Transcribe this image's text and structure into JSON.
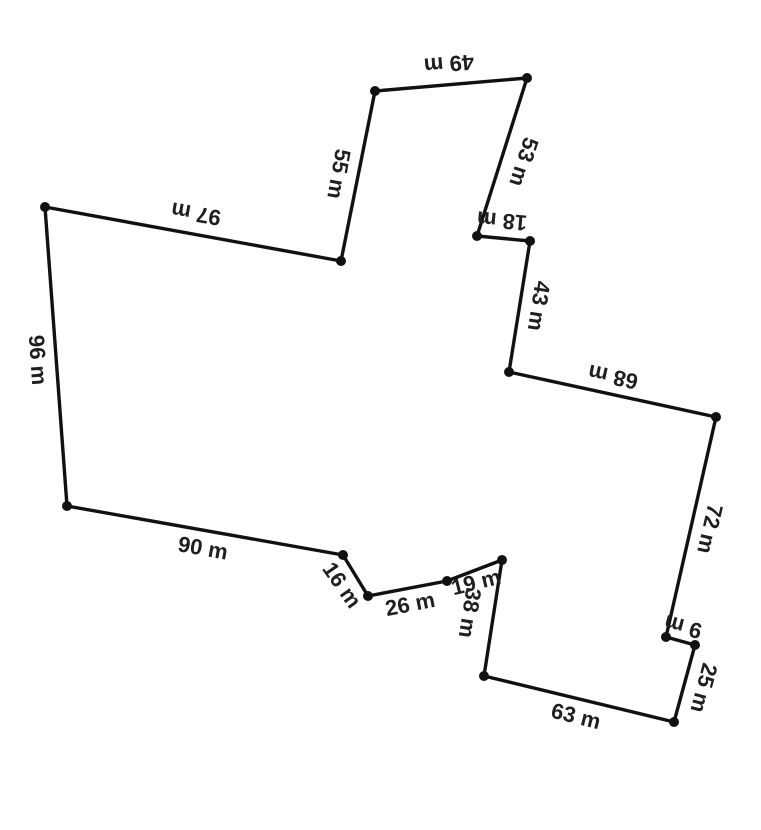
{
  "canvas": {
    "width": 761,
    "height": 830,
    "background": "#ffffff"
  },
  "style": {
    "line_color": "#111111",
    "line_width": 3.4,
    "vertex_color": "#111111",
    "vertex_radius": 5,
    "label_color": "#1f1f1f",
    "label_font_size": 22
  },
  "shape": {
    "type": "closed-polygon",
    "unit": "m",
    "vertices": [
      [
        45,
        207
      ],
      [
        341,
        261
      ],
      [
        375,
        91
      ],
      [
        527,
        78
      ],
      [
        477,
        236
      ],
      [
        530,
        241
      ],
      [
        509,
        372
      ],
      [
        716,
        417
      ],
      [
        666,
        637
      ],
      [
        695,
        645
      ],
      [
        674,
        722
      ],
      [
        484,
        676
      ],
      [
        502,
        560
      ],
      [
        447,
        581
      ],
      [
        368,
        596
      ],
      [
        343,
        555
      ],
      [
        67,
        506
      ]
    ],
    "edge_labels": [
      {
        "text": "97 m",
        "value": 97,
        "x": 196,
        "y": 214,
        "rotation": 190
      },
      {
        "text": "55 m",
        "value": 55,
        "x": 339,
        "y": 174,
        "rotation": 100
      },
      {
        "text": "49 m",
        "value": 49,
        "x": 449,
        "y": 64,
        "rotation": 175
      },
      {
        "text": "53 m",
        "value": 53,
        "x": 524,
        "y": 162,
        "rotation": 108
      },
      {
        "text": "18 m",
        "value": 18,
        "x": 502,
        "y": 221,
        "rotation": 185
      },
      {
        "text": "43 m",
        "value": 43,
        "x": 539,
        "y": 306,
        "rotation": 99
      },
      {
        "text": "68 m",
        "value": 68,
        "x": 613,
        "y": 377,
        "rotation": 192
      },
      {
        "text": "72 m",
        "value": 72,
        "x": 710,
        "y": 529,
        "rotation": 103
      },
      {
        "text": "9 m",
        "value": 9,
        "x": 683,
        "y": 627,
        "rotation": 195
      },
      {
        "text": "25 m",
        "value": 25,
        "x": 704,
        "y": 688,
        "rotation": 105
      },
      {
        "text": "63 m",
        "value": 63,
        "x": 576,
        "y": 716,
        "rotation": 14
      },
      {
        "text": "38 m",
        "value": 38,
        "x": 470,
        "y": 613,
        "rotation": 99
      },
      {
        "text": "19 m",
        "value": 19,
        "x": 476,
        "y": 582,
        "rotation": -14
      },
      {
        "text": "26 m",
        "value": 26,
        "x": 410,
        "y": 604,
        "rotation": -11
      },
      {
        "text": "16 m",
        "value": 16,
        "x": 342,
        "y": 585,
        "rotation": 55
      },
      {
        "text": "90 m",
        "value": 90,
        "x": 203,
        "y": 548,
        "rotation": 10
      },
      {
        "text": "96 m",
        "value": 96,
        "x": 38,
        "y": 360,
        "rotation": 86
      }
    ]
  }
}
